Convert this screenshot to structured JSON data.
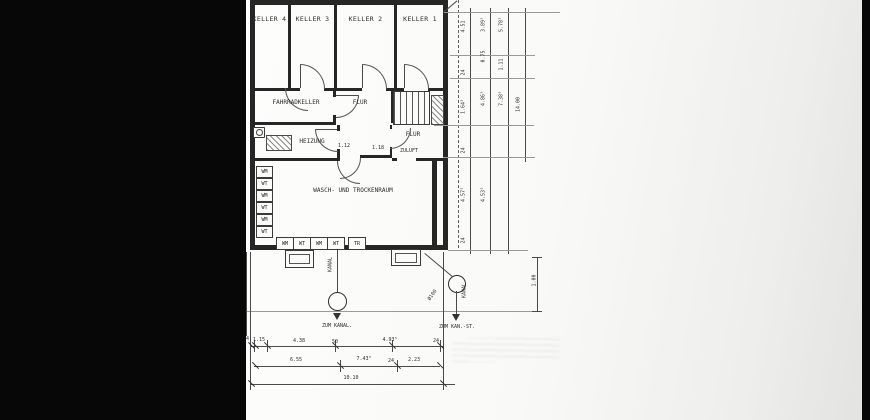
{
  "plan": {
    "rooms": {
      "keller4": "KELLER 4",
      "keller3": "KELLER 3",
      "keller2": "KELLER 2",
      "keller1": "KELLER 1",
      "fahrradkeller": "FAHRRADKELLER",
      "flur_mitte": "FLUR",
      "heizung": "HEIZUNG",
      "flur_rechts": "FLUR",
      "zuluft": "ZULUFT",
      "waschraum": "WASCH- UND TROCKENRAUM"
    },
    "door_widths": {
      "d1": "1.12",
      "d2": "1.18"
    },
    "equipment": {
      "left_column": [
        "WM",
        "WT",
        "WM",
        "WT",
        "WM",
        "WT"
      ],
      "bottom_row": [
        "WM",
        "WT",
        "WM",
        "WT",
        "TR"
      ]
    },
    "drainage": {
      "pipe1_vertical_label": "KANAL",
      "pipe1_target": "ZUM KANAL.",
      "pipe2_top_label": "KS",
      "pipe2_diag_label": "Ø100",
      "pipe2_side_label": "KANAL",
      "pipe2_target": "ZUM KAN.-ST.",
      "shaft_dim": "1.00"
    },
    "dims_bottom": {
      "row1": [
        "4",
        "1.15",
        "4.38",
        "50",
        "4.93⁵",
        "24"
      ],
      "row2": [
        "6.55",
        "7.43⁵",
        "24",
        "2.23"
      ],
      "total": "10.10"
    },
    "dims_right": {
      "col1": [
        "4.51",
        "1.64⁵",
        "4.57⁵"
      ],
      "col2": [
        "3.89⁵",
        "0.75",
        "4.86⁵",
        "4.53⁵"
      ],
      "col3": [
        "5.78⁵",
        "1.11",
        "7.38⁵"
      ],
      "col4": [
        "14.00"
      ],
      "ticks": [
        "24",
        "24",
        "24"
      ]
    },
    "colors": {
      "paper": "#f8f8f6",
      "ink": "#2d2d2d",
      "letterbox": "#070707"
    }
  }
}
